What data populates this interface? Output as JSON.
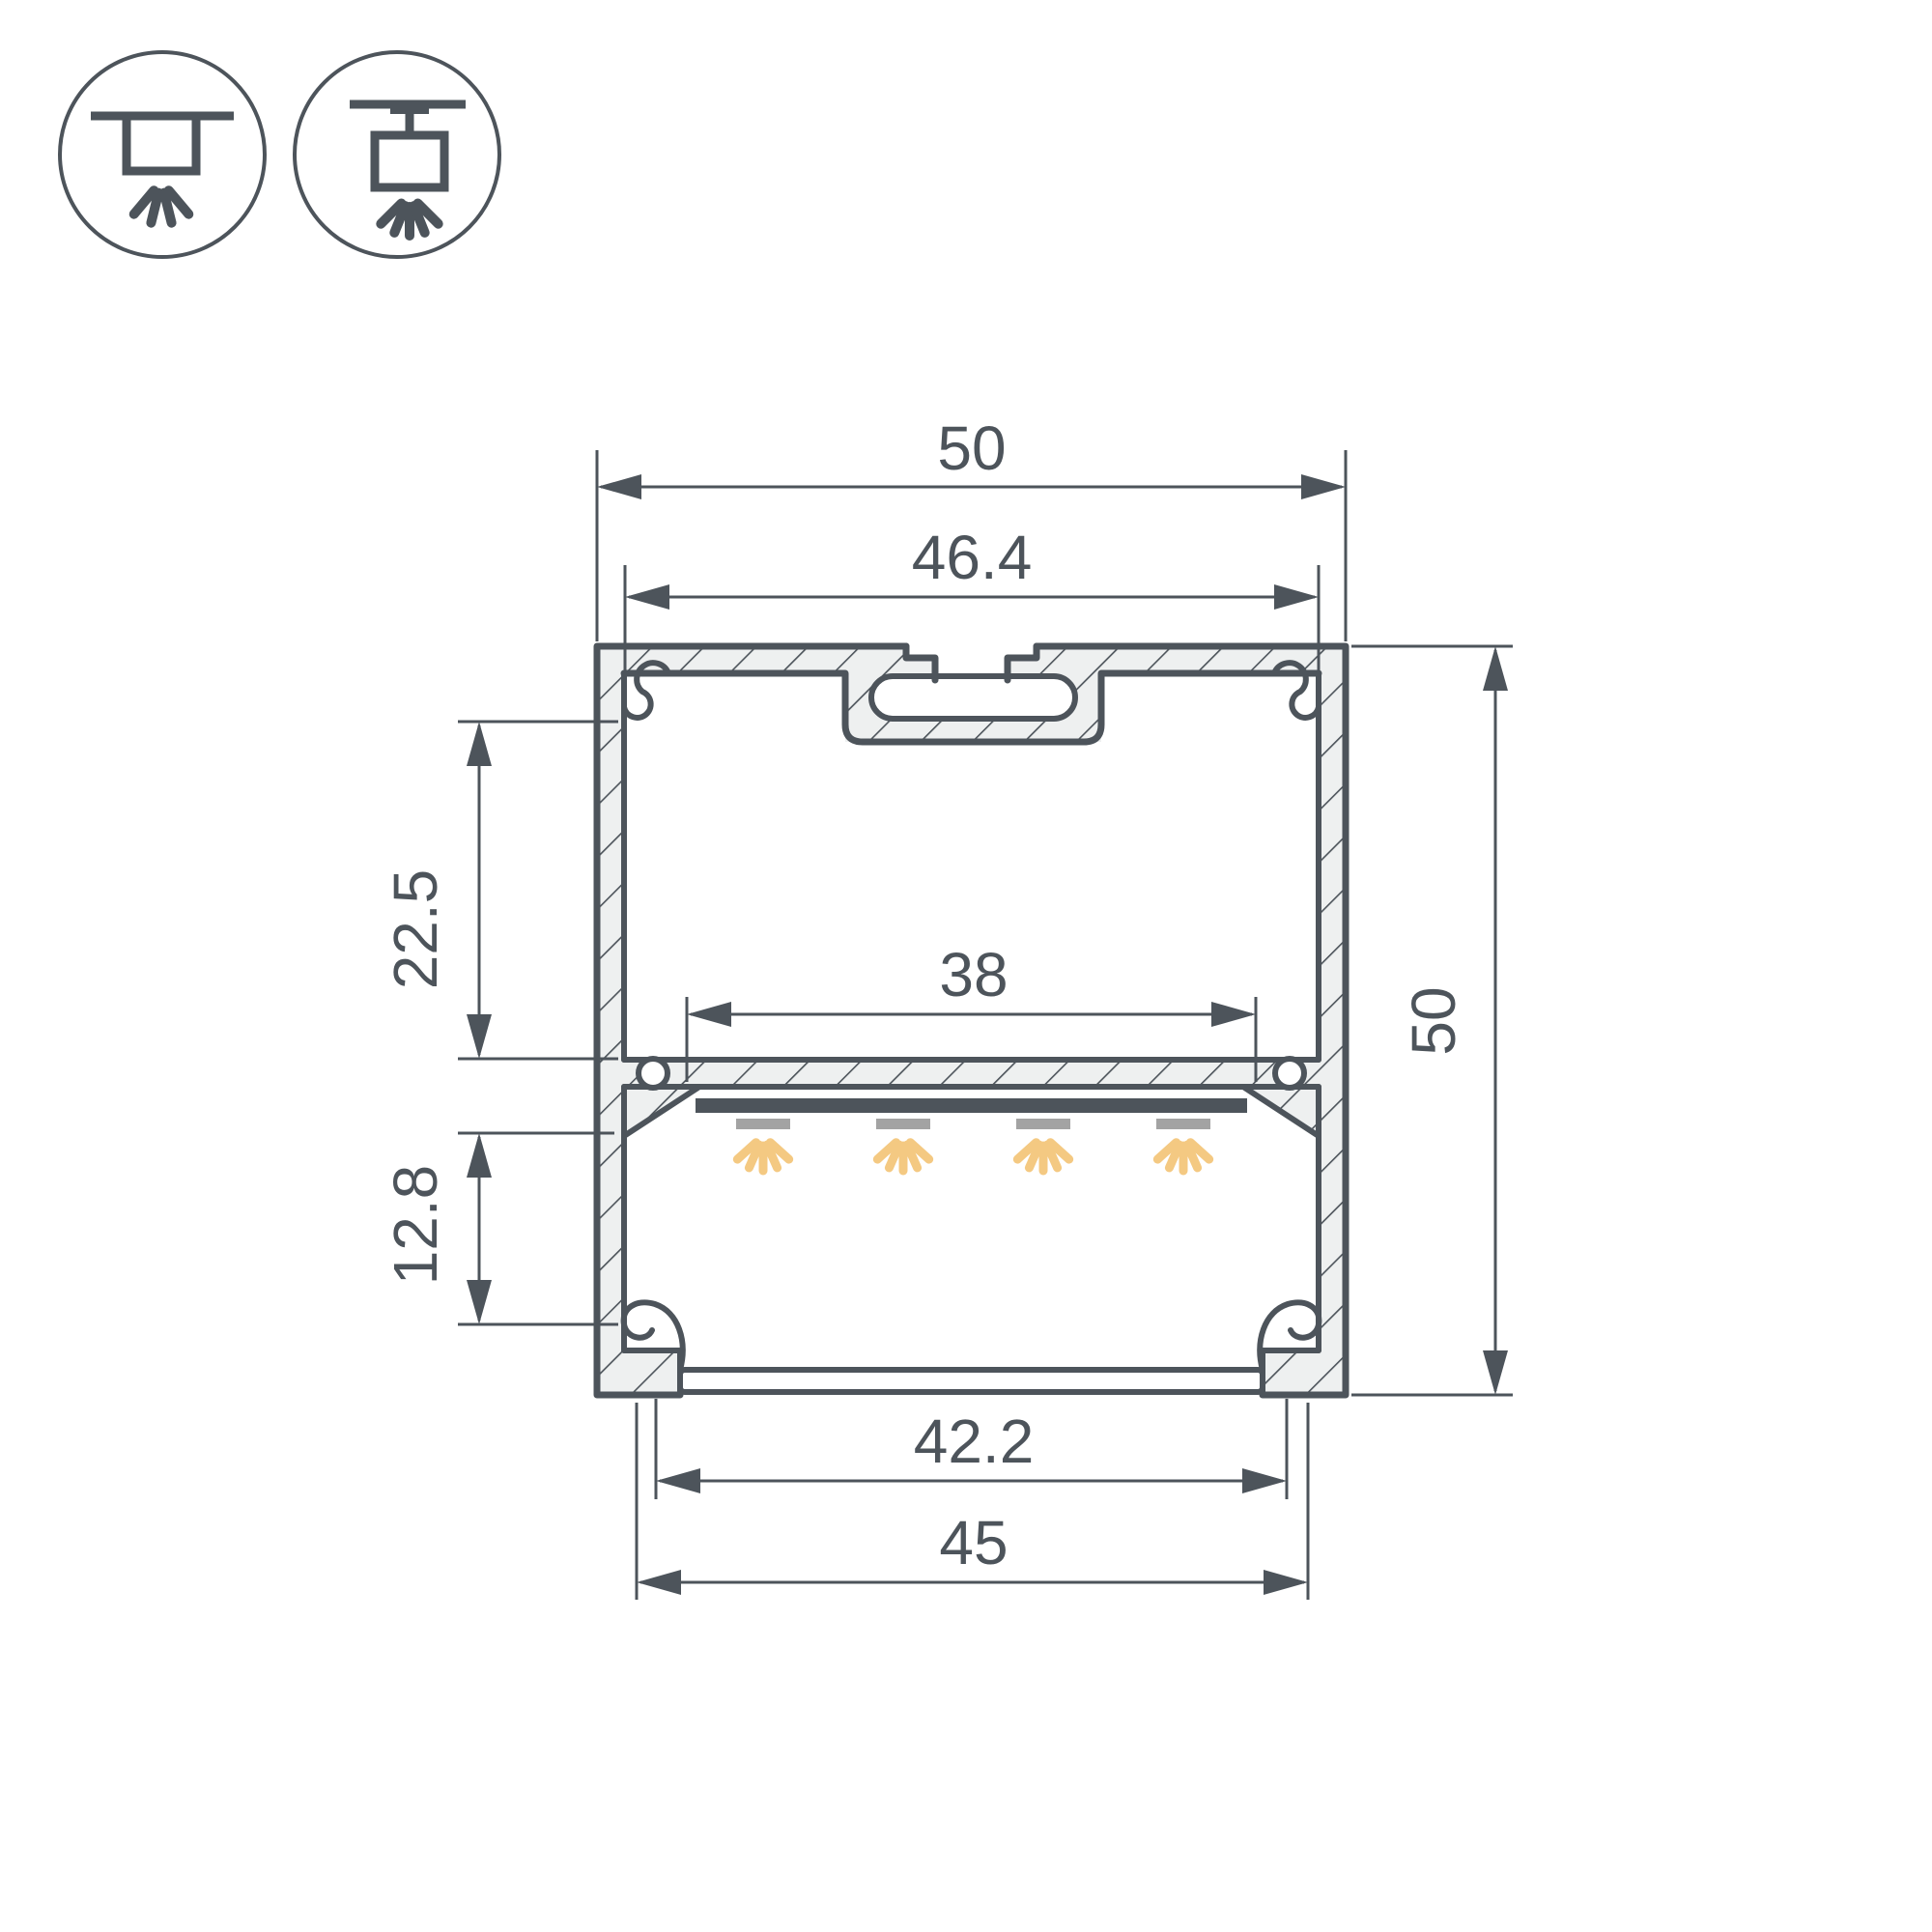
{
  "drawing": {
    "title": "LED aluminum profile cross-section with mounting icons",
    "type": "technical-dimension-drawing"
  },
  "icons": [
    {
      "name": "surface-mount-icon",
      "meaning": "surface ceiling mounting, light directed down"
    },
    {
      "name": "pendant-mount-icon",
      "meaning": "suspended / pendant mounting, light directed down"
    }
  ],
  "dimensions": {
    "outer_width": "50",
    "inner_top_width": "46.4",
    "led_platform_width": "38",
    "upper_section_height": "22.5",
    "lower_section_height": "12.8",
    "outer_height": "50",
    "diffuser_width": "42.2",
    "bottom_width": "45"
  },
  "colors": {
    "line": "#4d545b",
    "hatch_fill": "#eef0f0",
    "led_bar": "#4d545b",
    "led_module": "#a3a3a3",
    "light_ray": "#f4c982",
    "bg": "#ffffff"
  }
}
